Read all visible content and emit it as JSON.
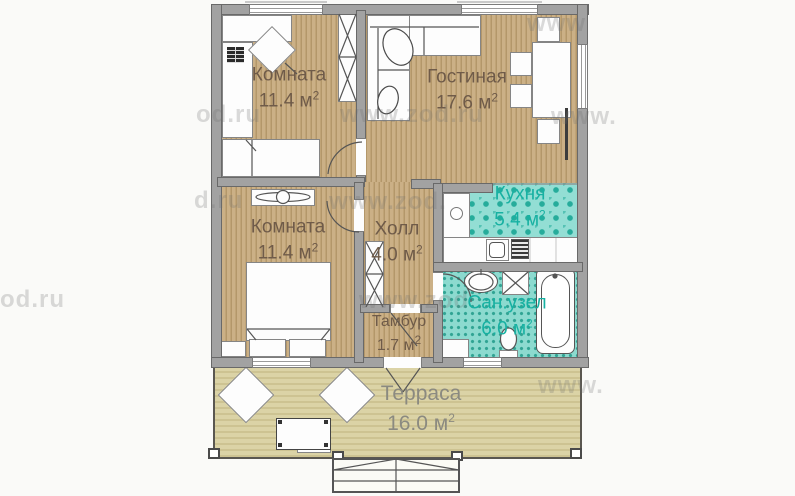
{
  "rooms": [
    {
      "id": "room-top-left",
      "name": "Комната",
      "area": "11.4 м",
      "sup": "2"
    },
    {
      "id": "living",
      "name": "Гостиная",
      "area": "17.6 м",
      "sup": "2"
    },
    {
      "id": "kitchen",
      "name": "Кухня",
      "area": "5.4 м",
      "sup": "2"
    },
    {
      "id": "room-bottom-left",
      "name": "Комната",
      "area": "11.4 м",
      "sup": "2"
    },
    {
      "id": "hall",
      "name": "Холл",
      "area": "4.0 м",
      "sup": "2"
    },
    {
      "id": "tambour",
      "name": "Тамбур",
      "area": "1.7 м",
      "sup": "2"
    },
    {
      "id": "bathroom",
      "name": "Сан.узел",
      "area": "6.0 м",
      "sup": "2"
    },
    {
      "id": "terrace",
      "name": "Терраса",
      "area": "16.0 м",
      "sup": "2"
    }
  ],
  "watermark_text": "www.zod.ru",
  "watermarks": [
    "www",
    "od.ru",
    "www.zod.ru",
    "www.",
    "d.ru",
    "www.zod.",
    "od.ru",
    "www.zod",
    "www."
  ],
  "colors": {
    "wall": "#a2a2a2",
    "wood_floor": "#c8ad83",
    "kitchen_tile": "#93ded4",
    "bath_tile": "#8cdacf",
    "terrace_floor": "#d8d1a4",
    "label_brown": "#6f5b49",
    "label_teal": "#17b1a2",
    "label_gray": "#8b8a80"
  }
}
